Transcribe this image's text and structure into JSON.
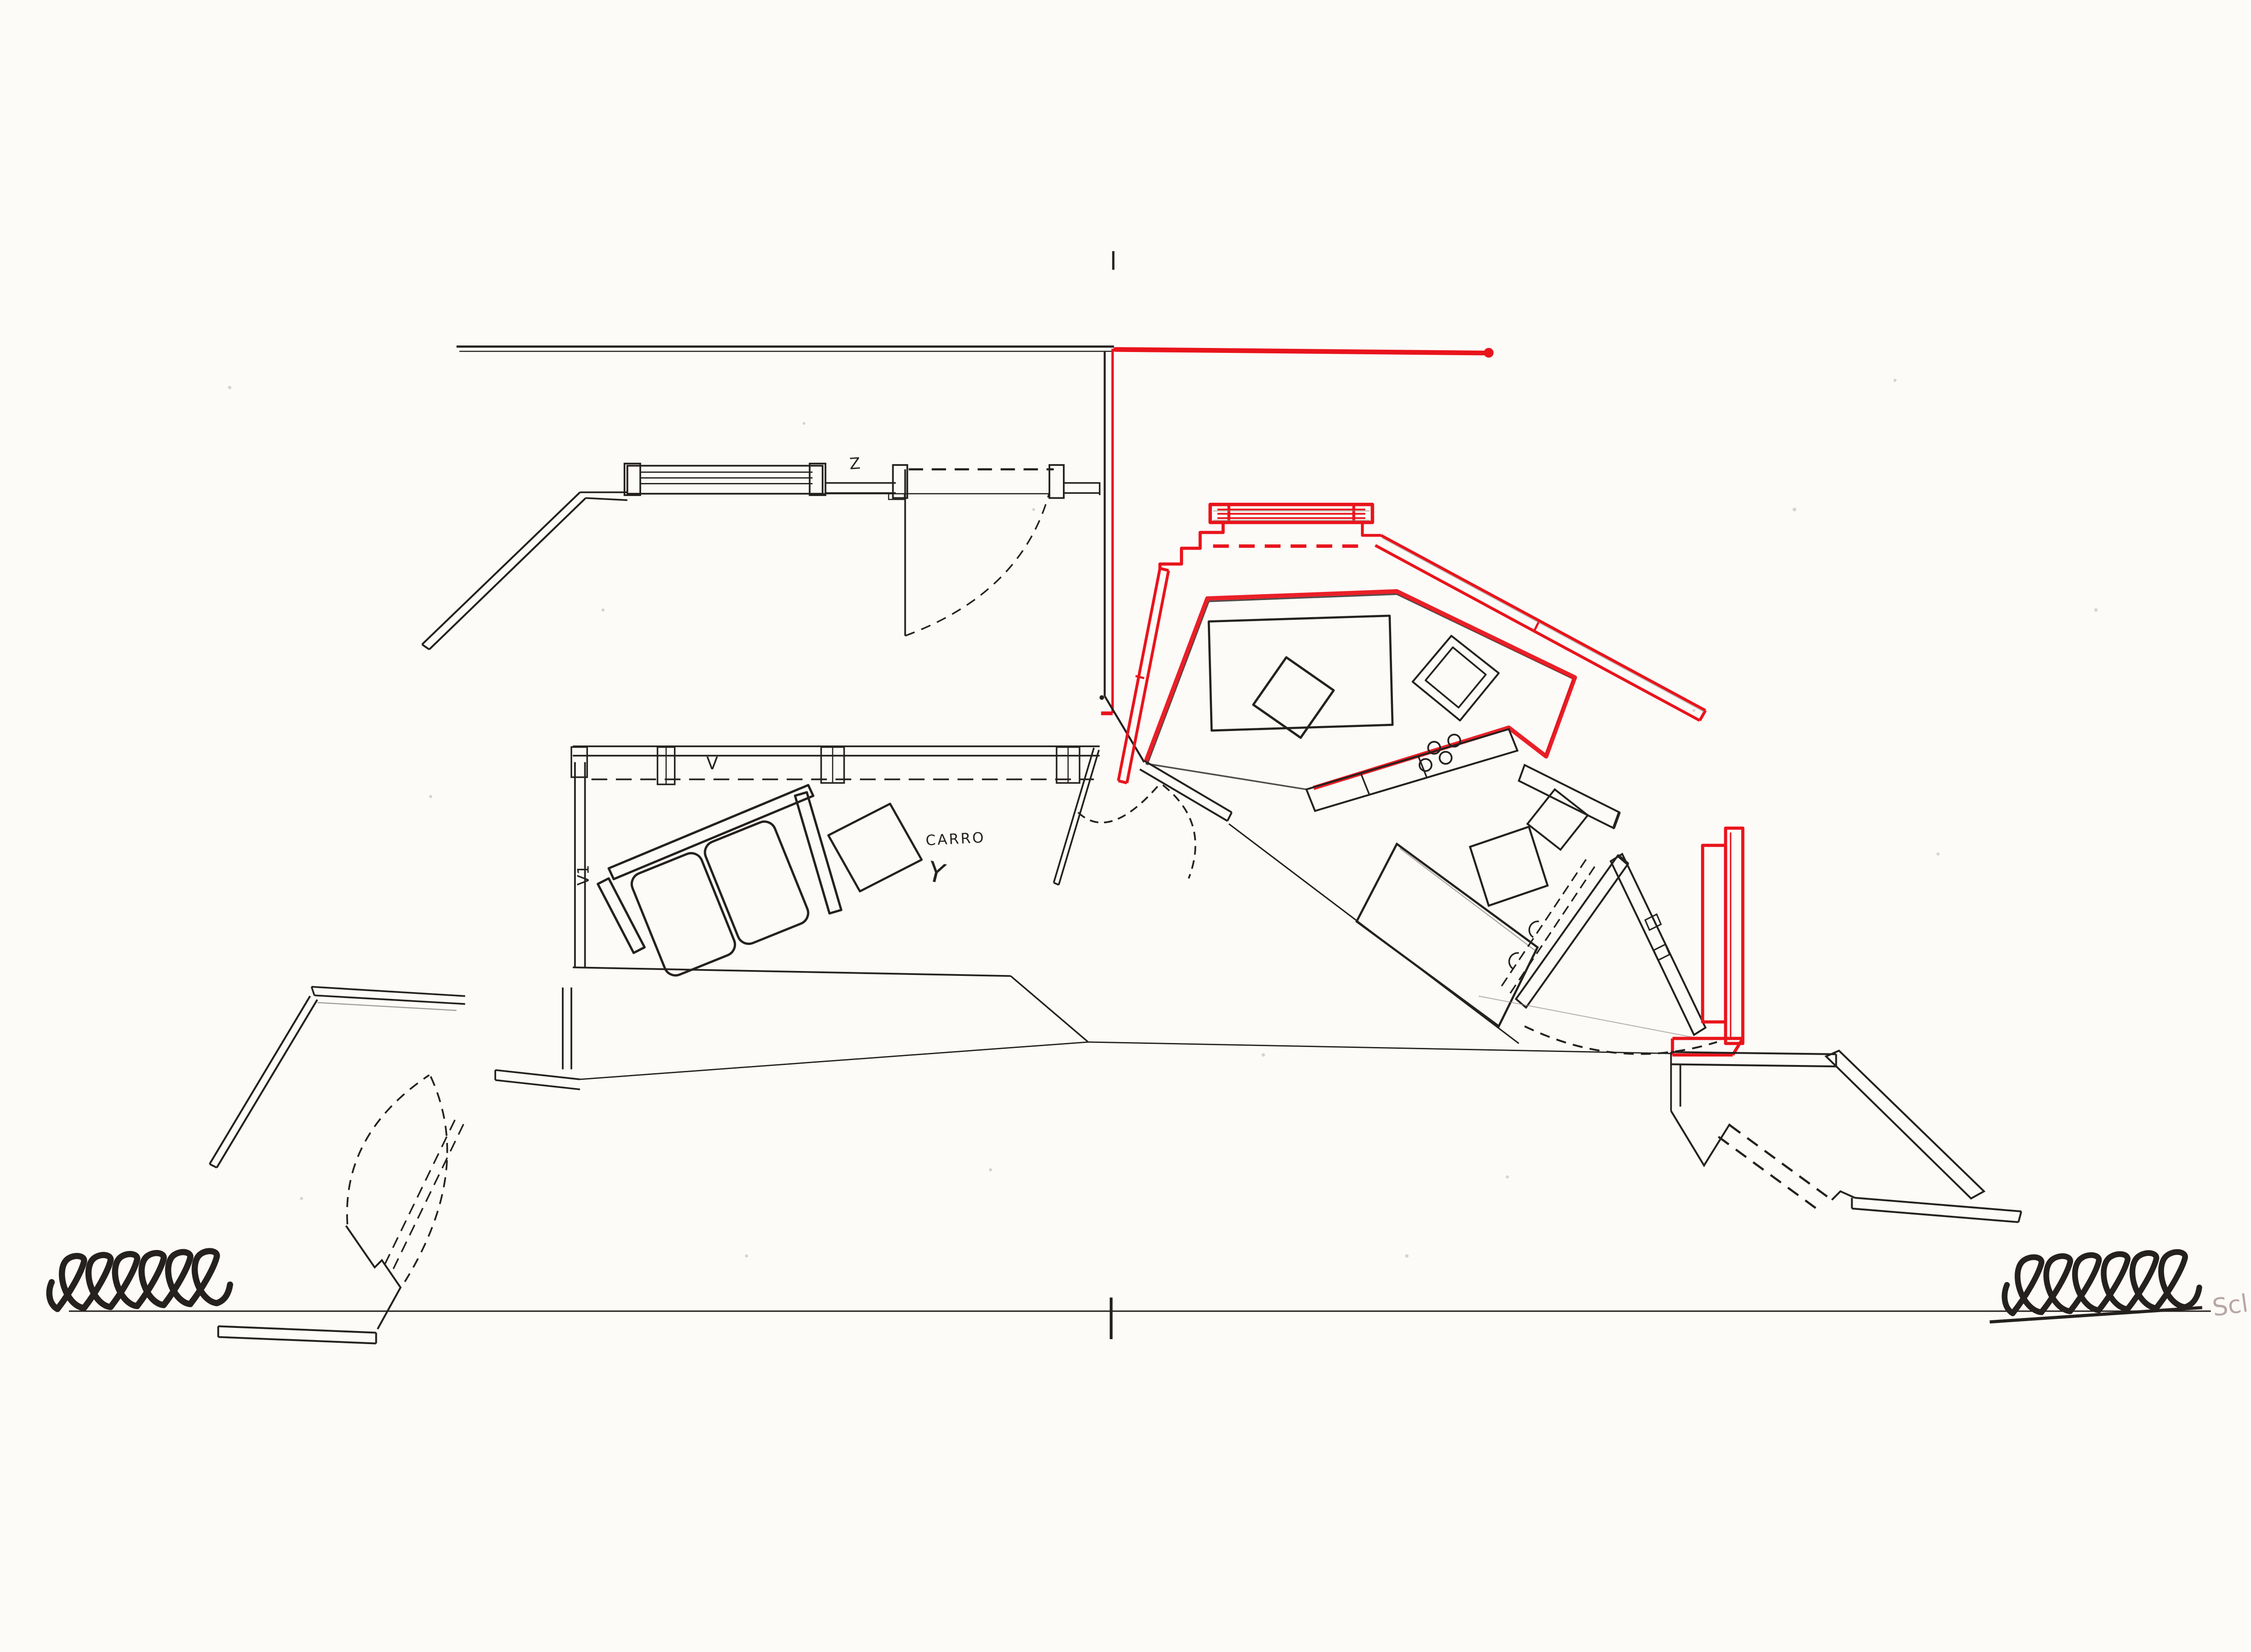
{
  "labels": {
    "door_top": "Z",
    "living_window": "V",
    "living_window_side": "V1",
    "cart": "CARRO",
    "cart_letter": "Y",
    "margin_note": "Scl"
  },
  "colors": {
    "ink": "#25211e",
    "red": "#e9141c",
    "pencil": "#8d867f",
    "note": "#b7a7a5",
    "paper": "#fcfbf8"
  },
  "symbols": {
    "left_break": "spring-squiggle",
    "right_break": "spring-squiggle"
  }
}
